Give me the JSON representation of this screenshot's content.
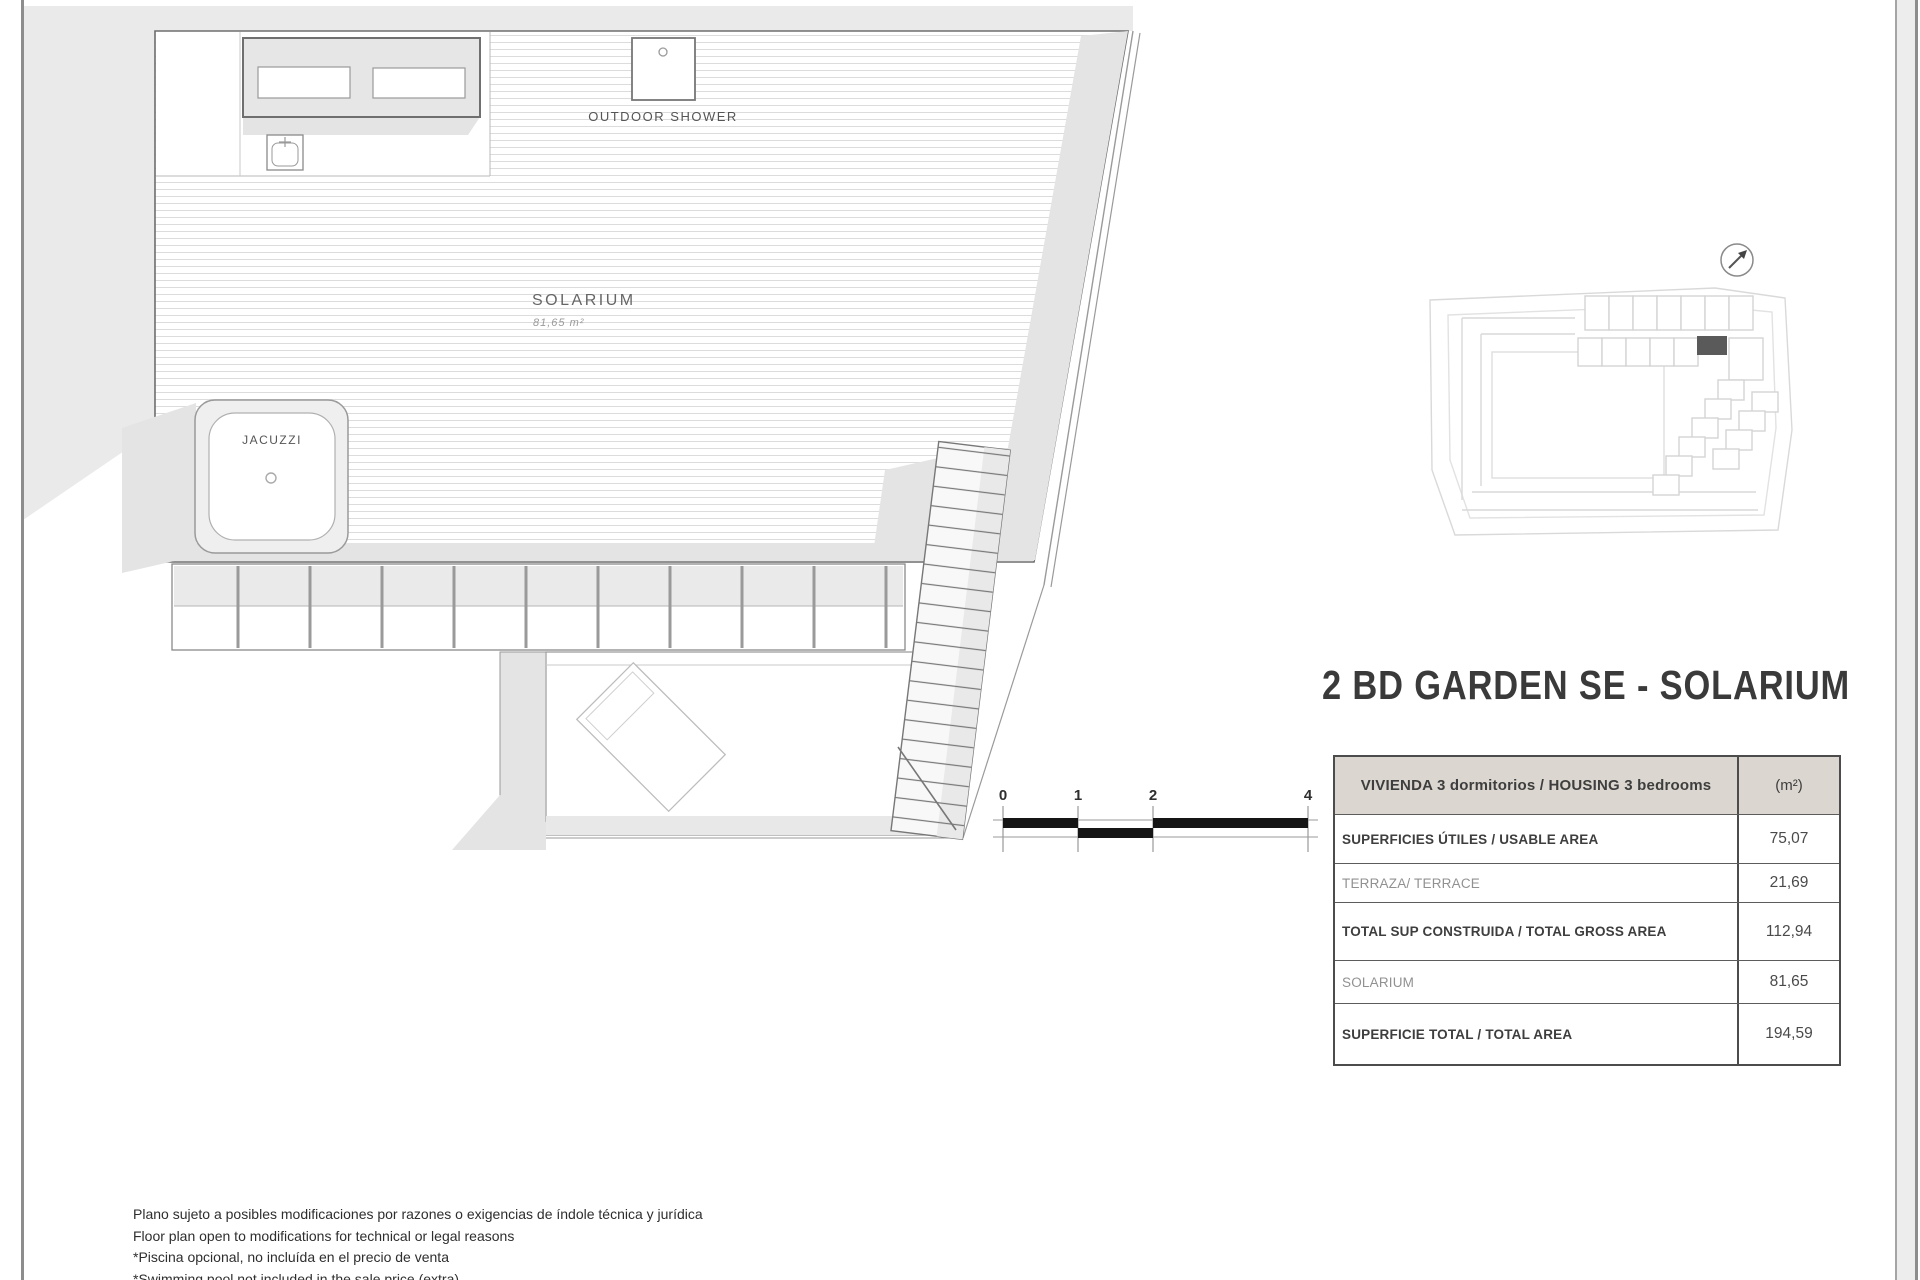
{
  "title": "2 BD GARDEN SE - SOLARIUM",
  "plan": {
    "room_label": "SOLARIUM",
    "room_area": "81,65 m²",
    "jacuzzi_label": "JACUZZI",
    "shower_label": "OUTDOOR SHOWER",
    "scale_ticks": [
      "0",
      "1",
      "2",
      "4"
    ]
  },
  "area_table": {
    "header_label": "VIVIENDA 3 dormitorios / HOUSING 3 bedrooms",
    "header_unit": "(m²)",
    "rows": [
      {
        "label": "SUPERFICIES ÚTILES / USABLE AREA",
        "value": "75,07"
      },
      {
        "label": "TERRAZA/ TERRACE",
        "value": "21,69"
      },
      {
        "label": "TOTAL SUP CONSTRUIDA / TOTAL GROSS AREA",
        "value": "112,94"
      },
      {
        "label": "SOLARIUM",
        "value": "81,65"
      },
      {
        "label": "SUPERFICIE TOTAL / TOTAL  AREA",
        "value": "194,59"
      }
    ]
  },
  "disclaimer": {
    "line1": "Plano sujeto a posibles modificaciones por razones o exigencias de índole técnica y jurídica",
    "line2": "Floor plan open to modifications for technical or legal reasons",
    "line3": "*Piscina opcional, no incluída en el precio de venta",
    "line4": "*Swimming pool not included in the sale price (extra)"
  },
  "colors": {
    "highlight_unit": "#5a5a5a",
    "table_header_bg": "#dbd7d0",
    "scale_bar_black": "#151515",
    "shadow_gray": "#e4e4e4"
  }
}
